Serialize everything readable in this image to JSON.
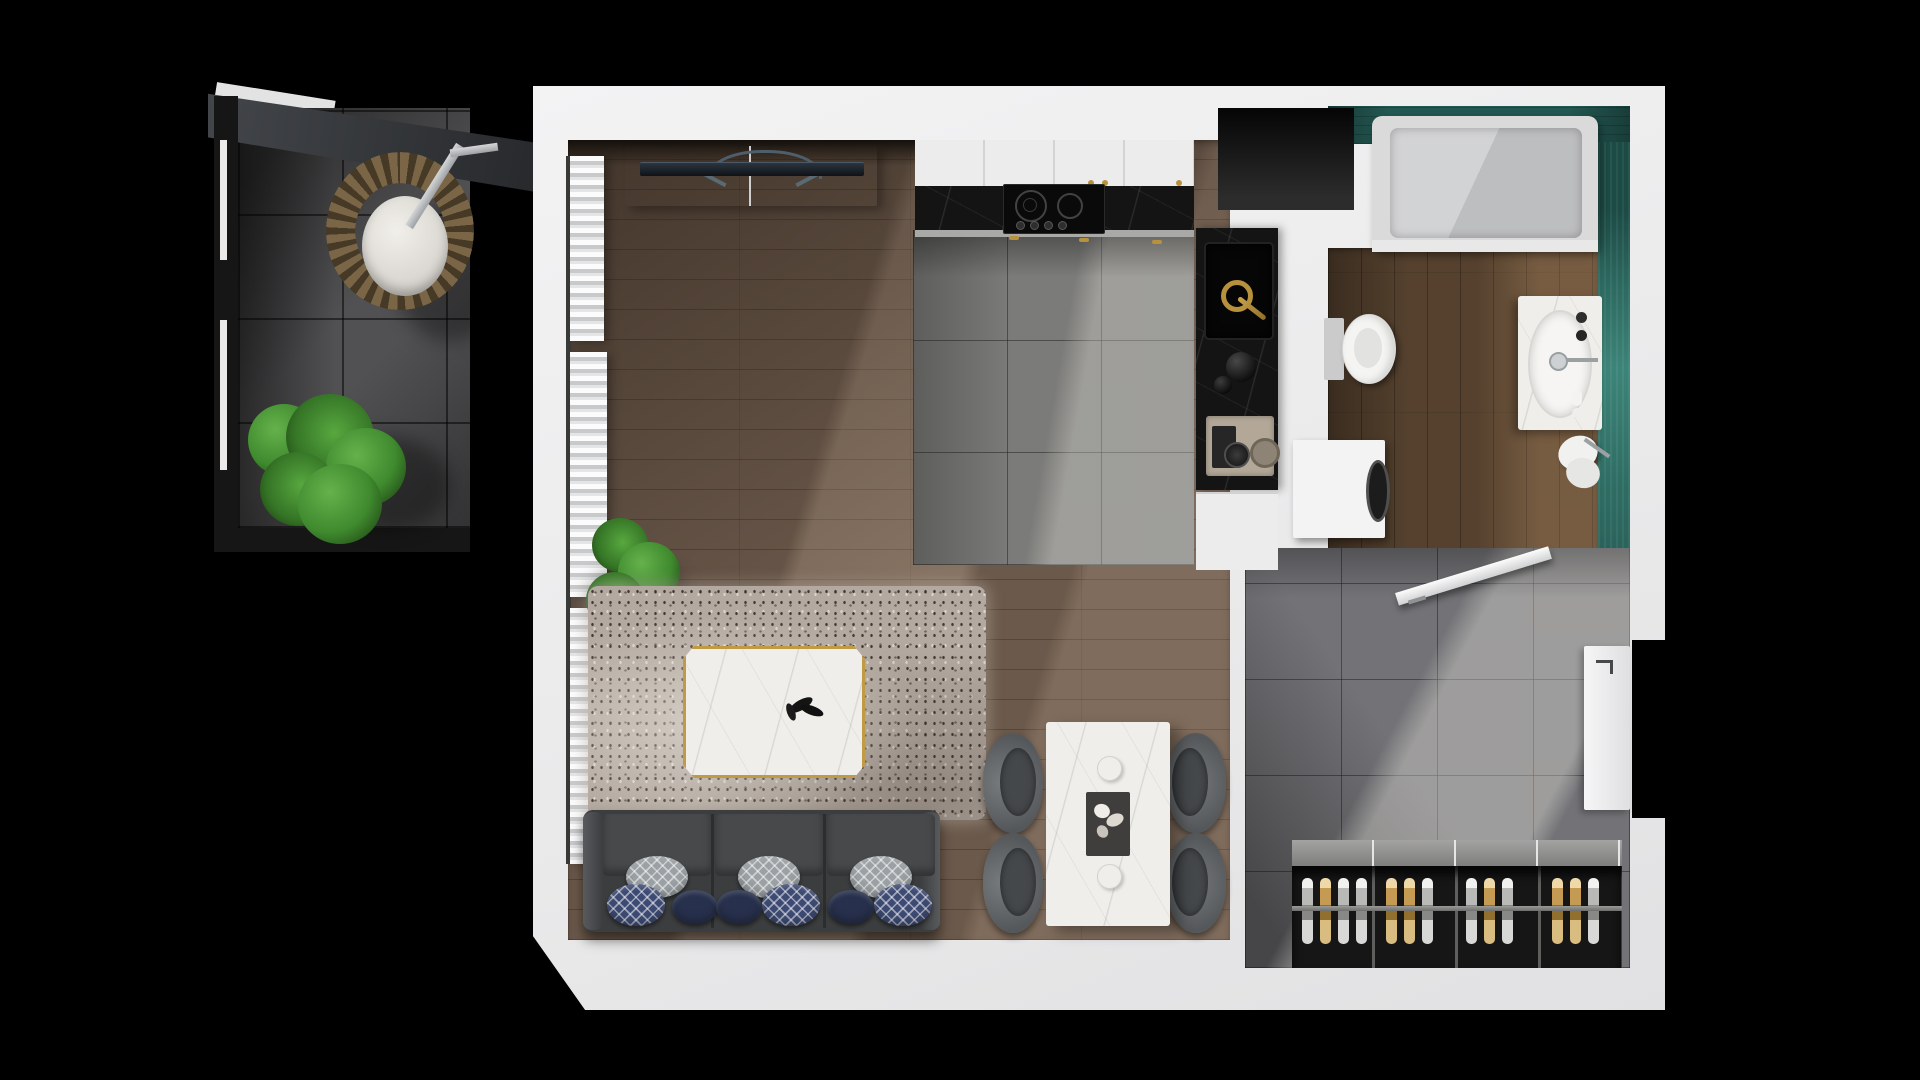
{
  "scene": {
    "label": "Top-down 3D rendered floor plan of a studio apartment with balcony",
    "view": "top-down architectural render",
    "background": "black"
  },
  "theme": {
    "background": "#000000",
    "wall": "#f0f0f1",
    "wood-floor": "#6b594b",
    "bath-wood": "#55412e",
    "tile-gray": "#7b7b79",
    "tile-entry": "#737377",
    "tile-balcony": "#515153",
    "teal-wall": "#235751",
    "teal-floor": "#3d8478",
    "counter-black": "#141414",
    "gold": "#b8913d",
    "sofa-gray": "#3b3d3f",
    "pillow-navy-solid": "#27304c",
    "pillow-navy-pattern": "#3d4a73",
    "pillow-gray": "#9aa0a3",
    "rug": "#b3a9a0",
    "marble-white": "#f0eeea",
    "chair-gray": "#6e7173",
    "plant-green": "#3f8a2e",
    "rattan": "#7a6647"
  },
  "rooms": {
    "balcony": {
      "label": "Balcony with hanging egg chair and potted plant"
    },
    "living": {
      "label": "Living room with TV console, curtains, shag rug, marble coffee table and sofa"
    },
    "kitchen": {
      "label": "Kitchen with white cabinets, black marble counter, cooktop and sink"
    },
    "dining": {
      "label": "Dining area with white marble table and four gray chairs"
    },
    "bathroom": {
      "label": "Bathroom with teal tile walls, bathtub, toilet and vanity sink"
    },
    "entry": {
      "label": "Entry hall with open bathroom door, entrance door and wine rack"
    }
  },
  "inventory": {
    "sofa": {
      "seats": 3,
      "pillows": 9,
      "pillow_styles": [
        "gray-lattice",
        "navy-lattice",
        "navy-solid"
      ]
    },
    "cooktop": {
      "burners": 2,
      "knobs": 4
    },
    "dining": {
      "chairs": 4,
      "plates": 2,
      "tray_items": "white flowers"
    },
    "wine_rack": {
      "compartments": 4,
      "bottles": 13
    },
    "balcony": [
      "hanging-egg-chair",
      "potted-plant",
      "awning",
      "glazed-wall"
    ],
    "kitchen_items": [
      "induction-cooktop",
      "black-marble-counter",
      "sink",
      "gold-faucet",
      "kettle",
      "coffee-machine",
      "washing-machine"
    ],
    "bathroom_items": [
      "bathtub",
      "toilet",
      "vanity-oval-sink",
      "toilet-brush"
    ]
  }
}
